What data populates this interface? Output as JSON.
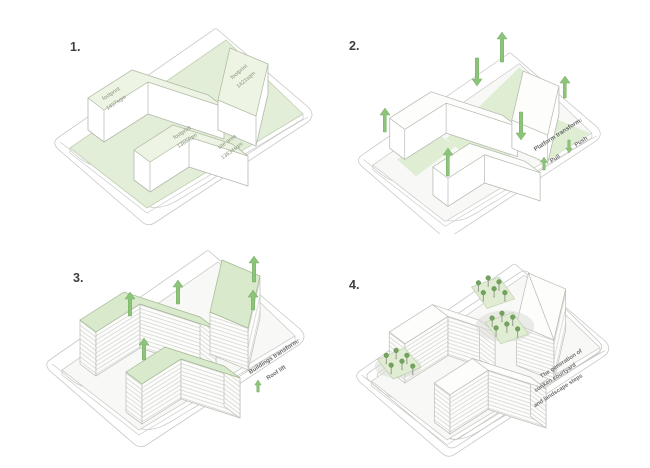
{
  "diagram_title": "massing transformation steps",
  "colors": {
    "platform_green": "#e2eed7",
    "roof_green": "#d9e9cb",
    "arrow_green": "#8cc47a",
    "line_gray": "#c7c7c4",
    "label_gray_green": "#879178",
    "caption_gray": "#6e6e6e"
  },
  "panels": [
    {
      "number": "1.",
      "labels": {
        "building_a": [
          "footprint",
          "1437sqm"
        ],
        "building_b": [
          "footprint",
          "1386sqm"
        ],
        "building_c": [
          "footprint",
          "1421sqm"
        ],
        "site": [
          "site area",
          "13634sqm"
        ]
      }
    },
    {
      "number": "2.",
      "caption": "Platform transform:",
      "legend": [
        {
          "icon": "arrow-up-icon",
          "label": "Pull"
        },
        {
          "icon": "arrow-down-icon",
          "label": "Push"
        }
      ]
    },
    {
      "number": "3.",
      "caption": "Buildings transform:",
      "sub": "Roof lift",
      "legend_icon": "arrow-up-icon"
    },
    {
      "number": "4.",
      "caption": [
        "The generation of",
        "sunken courtyard",
        "and landscape steps"
      ]
    }
  ]
}
